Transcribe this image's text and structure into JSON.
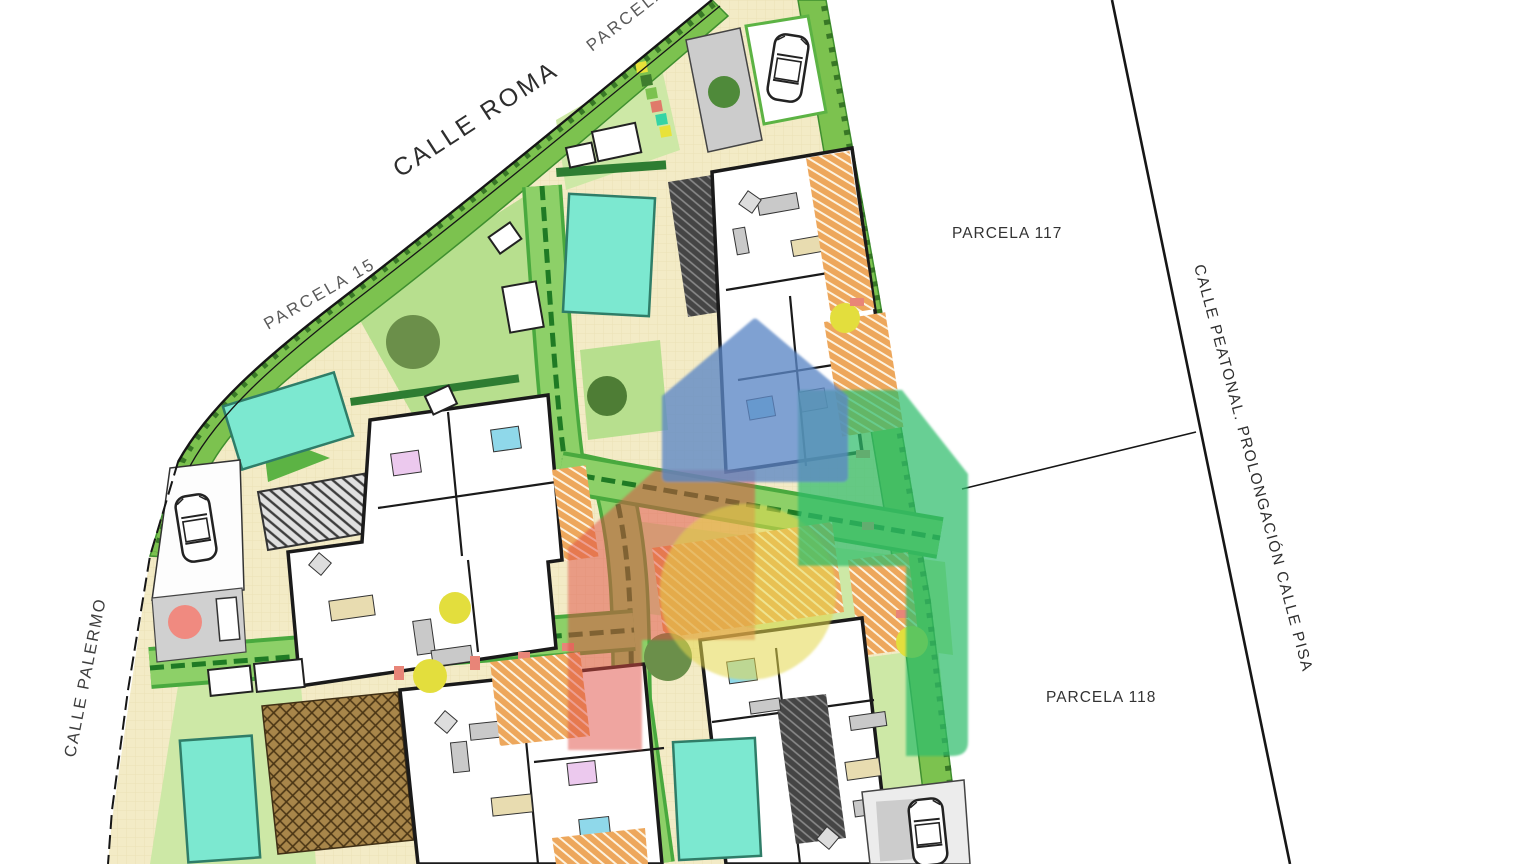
{
  "labels": {
    "calle_roma": "CALLE ROMA",
    "calle_palermo": "CALLE PALERMO",
    "calle_peatonal": "CALLE PEATONAL. PROLONGACIÓN CALLE PISA",
    "parcela_15": "PARCELA 15",
    "parcela_top": "PARCELA 1",
    "parcela_117": "PARCELA 117",
    "parcela_118": "PARCELA 118"
  },
  "palette": {
    "background": "#ffffff",
    "road_green": "#8dd068",
    "verge_green": "#7cc24f",
    "road_center_green": "#1f7a24",
    "lawn_green": "#cde8a6",
    "lawn_bright": "#b7df8e",
    "patio_cream": "#f3ebc6",
    "pool_teal": "#7ce8d0",
    "terrace_orange": "#eda75c",
    "pergola_dark": "#454545",
    "pergola_brown": "#a8864a",
    "slab_gray": "#cfcfcf",
    "tree_dark": "#4e7d35",
    "tree_olive": "#6b8f4a",
    "shrub_yellow": "#e3de3d",
    "shrub_red": "#f08a80",
    "wall_black": "#1a1a1a",
    "boundary_black": "#161616"
  },
  "watermark": {
    "blue": "#5b87c5",
    "red": "#e0493f",
    "green": "#2ebd6b",
    "yellow": "#e3d74a"
  },
  "features": {
    "villas": 4,
    "pools": 4,
    "cars": 3,
    "trees": 5,
    "yellow_shrubs": 4,
    "red_shrubs": 1
  }
}
